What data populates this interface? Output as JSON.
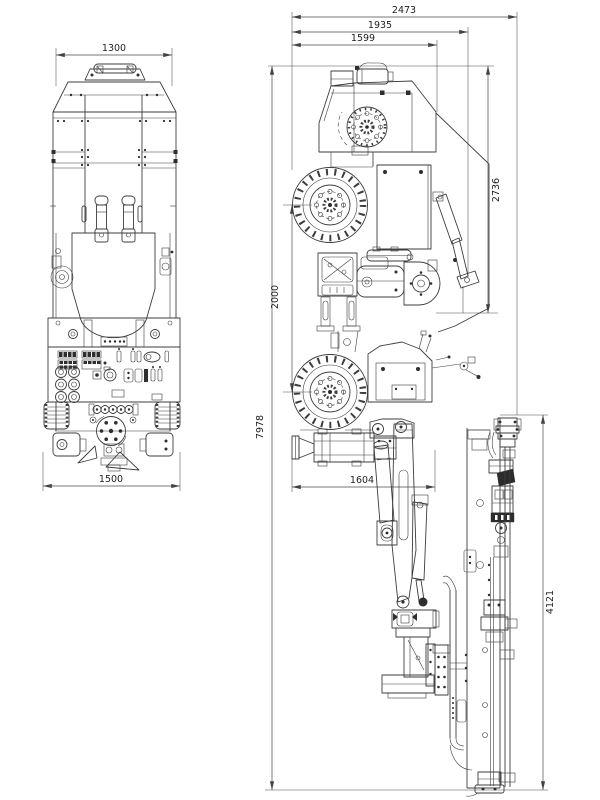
{
  "drawing": {
    "kind": "engineering-dimension-drawing",
    "subject": "drilling rig (plan view and side view)"
  },
  "colors": {
    "background": "#ffffff",
    "line": "#3d3d3d",
    "dimension_line": "#4a4a4a",
    "text": "#1f1f1f"
  },
  "dimensions": {
    "plan": {
      "top": "1300",
      "bottom": "1500"
    },
    "side": {
      "top_outer": "2473",
      "top_mid": "1935",
      "top_inner": "1599",
      "right_height": "2736",
      "left_wheelbase": "2000",
      "left_overall": "7978",
      "mid_drifter": "1604",
      "right_feed": "4121"
    }
  }
}
